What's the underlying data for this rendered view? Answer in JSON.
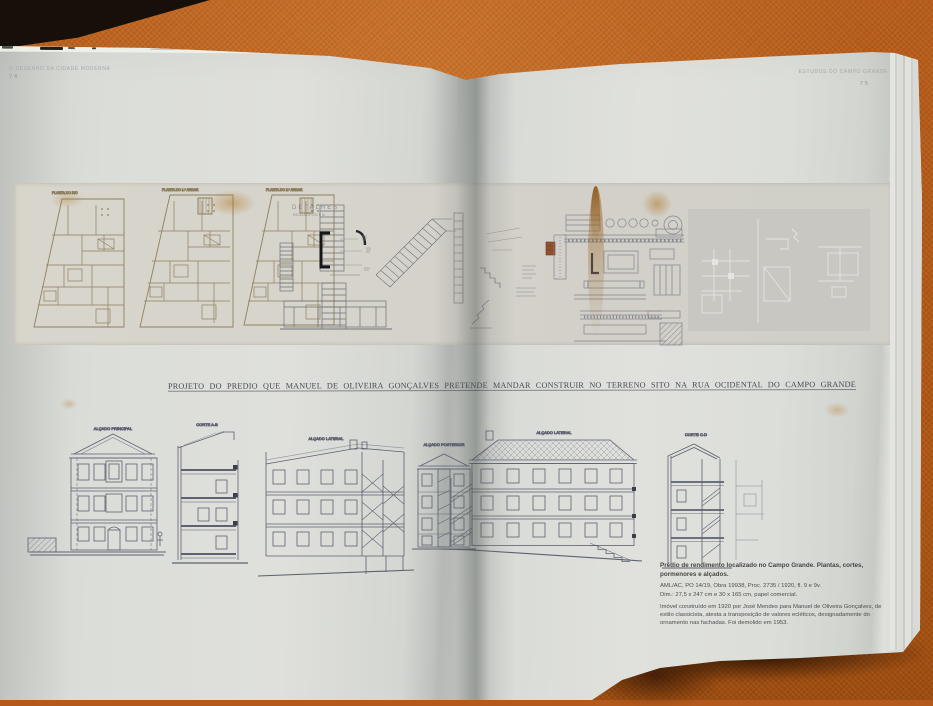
{
  "page": {
    "left": {
      "header": "O DESENHO DA CIDADE MODERNA",
      "number": "74"
    },
    "right": {
      "header": "ESTUDOS DO CAMPO GRANDE",
      "number": "75"
    }
  },
  "figures": {
    "top": {
      "detalhes_label": "DETALHES",
      "detalhes_sublabel": "ESCALA DE 0,01 P. M.",
      "plan_labels": [
        "PLANTA DO R/C",
        "PLANTA DO 1.º ANDAR",
        "PLANTA DO 2.º ANDAR"
      ]
    },
    "title": "PROJETO DO PREDIO QUE MANUEL DE OLIVEIRA GONÇALVES PRETENDE MANDAR CONSTRUIR NO TERRENO SITO NA RUA OCIDENTAL DO CAMPO GRANDE",
    "bottom": {
      "labels": [
        "ALÇADO PRINCIPAL",
        "CORTE A-B",
        "ALÇADO LATERAL",
        "ALÇADO POSTERIOR",
        "ALÇADO LATERAL",
        "CORTE C-D"
      ]
    }
  },
  "caption": {
    "heading": "Prédio de rendimento localizado no Campo Grande. Plantas, cortes, pormenores e alçados.",
    "ref1": "AML/AC, PO 14/19, Obra 19938, Proc. 2735 / 1920, fl. 9 e 9v.",
    "ref2": "Dim.: 27,5 x 247 cm e 30 x 165 cm, papel comercial.",
    "body": "Imóvel construído em 1920 por José Mendes para Manuel de Oliveira Gonçalves, de estilo classicista, atesta a transposição de valores ecléticos, designadamente do ornamento nas fachadas. Foi demolido em 1953."
  },
  "colors": {
    "fabric": "#b45c1a",
    "page": "#dcdedb",
    "ink_blue": "#5d6170",
    "ink_sepia": "#8f7f60",
    "stain": "#b07a28"
  }
}
